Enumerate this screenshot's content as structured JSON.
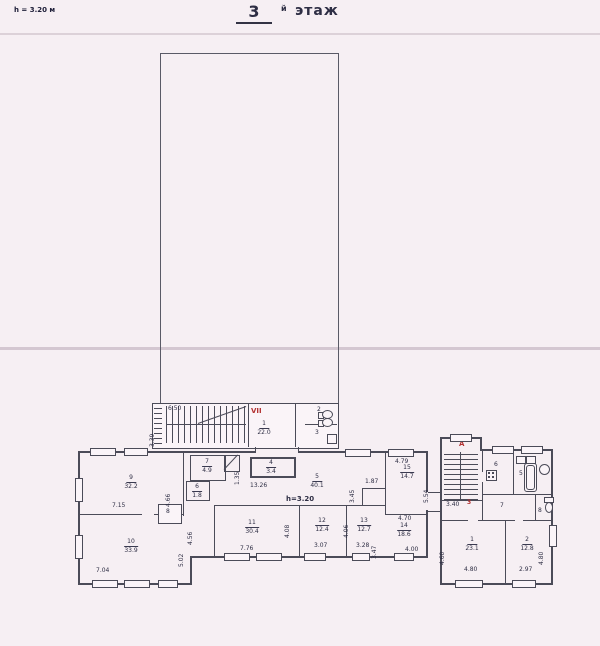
{
  "header": {
    "height_note": "h = 3.20 м",
    "floor_number": "3",
    "floor_suffix": "й",
    "floor_word": "этаж"
  },
  "colors": {
    "background": "#f6eff3",
    "line": "#4b4b58",
    "accent_red": "#b23030"
  },
  "upper_block": {
    "stair_section": "VII",
    "stair_width_dim": "6.50",
    "stair_height_dim": "3.39",
    "room1": {
      "number": "1",
      "area": "22.0"
    },
    "room2": {
      "number": "2"
    },
    "room3": {
      "number": "3"
    }
  },
  "main_wing": {
    "height_note": "h=3.20",
    "rooms": {
      "r4": {
        "number": "4",
        "area": "3.4"
      },
      "r5": {
        "number": "5",
        "area": "40.1"
      },
      "r6": {
        "number": "6",
        "area": "1.8"
      },
      "r7": {
        "number": "7",
        "area": "4.9"
      },
      "r8": {
        "number": "8"
      },
      "r9": {
        "number": "9",
        "area": "32.2"
      },
      "r10": {
        "number": "10",
        "area": "33.9"
      },
      "r11": {
        "number": "11",
        "area": "30.4"
      },
      "r12": {
        "number": "12",
        "area": "12.4"
      },
      "r13": {
        "number": "13",
        "area": "12.7"
      },
      "r14": {
        "number": "14",
        "area": "18.6"
      },
      "r15": {
        "number": "15",
        "area": "14.7"
      }
    },
    "dims": {
      "corridor_w": "13.26",
      "corridor_v": "1.35",
      "r15_top": "4.79",
      "r15_left": "1.87",
      "wing_right_v": "5.54",
      "open_v": "3.45",
      "r14_top": "4.70",
      "r9_w": "7.15",
      "r9_h": "4.66",
      "r10_w": "7.04",
      "r10_h": "5.02",
      "col_h": "4.56",
      "r11_w": "7.76",
      "r12_h": "4.08",
      "r12_w": "3.07",
      "r13_h": "4.06",
      "r13_w": "3.28",
      "r14_h": "3.47",
      "r14_w": "4.00"
    }
  },
  "right_wing": {
    "stair_section": "А",
    "red_mark": "3",
    "stair_dim": "3.40",
    "rooms": {
      "r6": {
        "number": "6"
      },
      "r5": {
        "number": "5"
      },
      "r7": {
        "number": "7"
      },
      "r8": {
        "number": "8"
      },
      "r1": {
        "number": "1",
        "area": "23.1"
      },
      "r2": {
        "number": "2",
        "area": "12.8"
      }
    },
    "dims": {
      "r1_w": "4.80",
      "r1_h": "4.60",
      "r2_w": "2.97",
      "r2_h": "4.80"
    }
  }
}
